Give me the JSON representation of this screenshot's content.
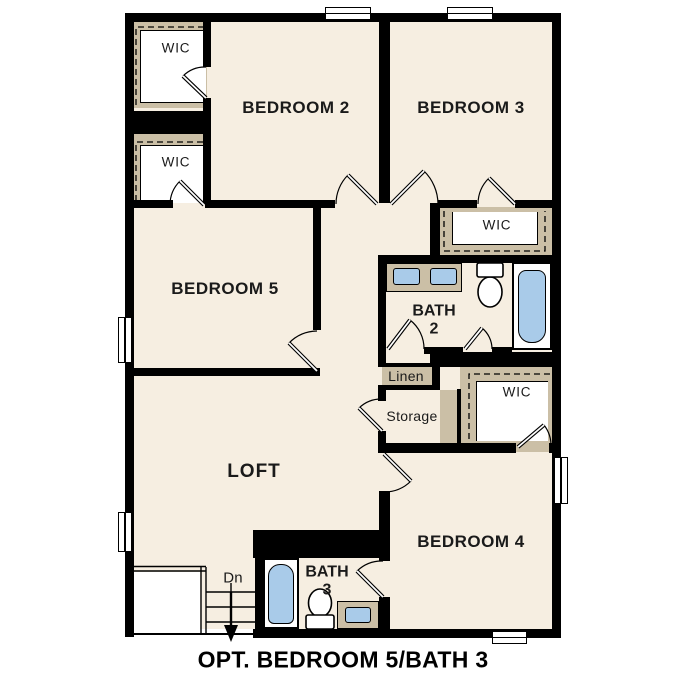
{
  "plan": {
    "caption": "OPT. BEDROOM 5/BATH 3",
    "rooms": {
      "bedroom2": "BEDROOM 2",
      "bedroom3": "BEDROOM 3",
      "bedroom5": "BEDROOM 5",
      "bedroom4": "BEDROOM 4",
      "loft": "LOFT",
      "bath2": {
        "line1": "BATH",
        "line2": "2"
      },
      "bath3": {
        "line1": "BATH",
        "line2": "3"
      },
      "wic": "WIC",
      "linen": "Linen",
      "storage": "Storage",
      "stairs_down": "Dn"
    },
    "colors": {
      "background": "#FFFFFF",
      "floor": "#F6EEE1",
      "wall": "#000000",
      "closet_poche": "#CBBFA6",
      "fixture_blue": "#A9CBE9"
    }
  }
}
